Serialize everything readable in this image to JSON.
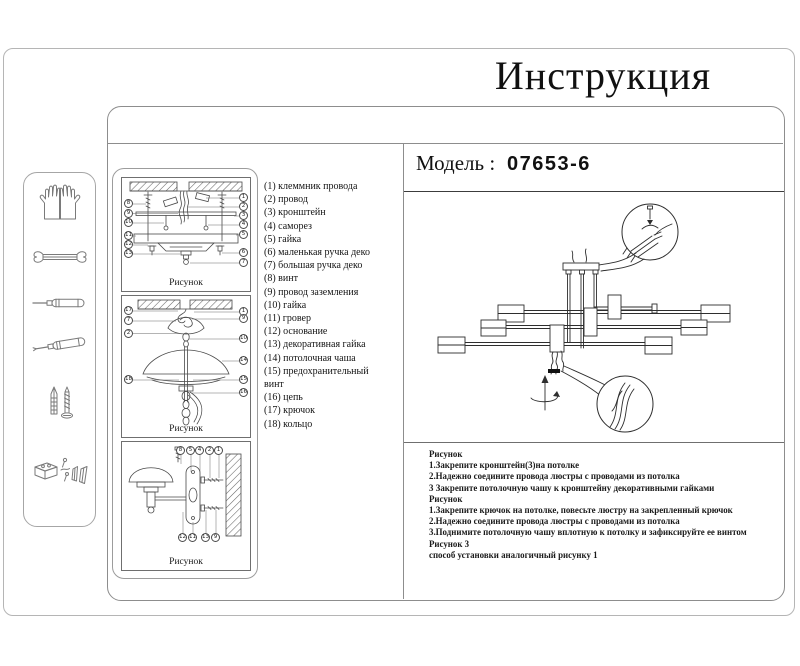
{
  "title": "Инструкция",
  "model": {
    "label": "Модель :",
    "value": "07653-6"
  },
  "parts_list": [
    "(1) клеммник провода",
    "(2) провод",
    "(3) кронштейн",
    "(4) саморез",
    "(5) гайка",
    "(6) маленькая ручка деко",
    "(7) большая ручка деко",
    "(8) винт",
    "(9) провод заземления",
    "(10) гайка",
    "(11) гровер",
    "(12) основание",
    "(13) декоративная гайка",
    "(14) потолочная чаша",
    "(15) предохранительный винт",
    "(16) цепь",
    "(17) крючок",
    "(18) кольцо"
  ],
  "figures": {
    "fig1": {
      "caption": "Рисунок",
      "callouts_left": [
        "8",
        "9",
        "10",
        "11",
        "12",
        "13"
      ],
      "callouts_right": [
        "1",
        "2",
        "3",
        "4",
        "5",
        "6",
        "7"
      ]
    },
    "fig2": {
      "caption": "Рисунок",
      "callouts_left": [
        "17",
        "7",
        "2",
        "18"
      ],
      "callouts_right": [
        "1",
        "9",
        "10",
        "14",
        "15",
        "16"
      ]
    },
    "fig3": {
      "caption": "Рисунок",
      "callouts_top": [
        "8",
        "5",
        "4",
        "2",
        "1"
      ],
      "callouts_bottom": [
        "12",
        "11",
        "13",
        "9"
      ]
    }
  },
  "instructions": [
    "Рисунок",
    "1.Закрепите кронштейн(3)на потолке",
    "2.Надежно соедините провода люстры с проводами из потолка",
    "3 Закрепите потолочную чашу к кронштейну декоративными гайками",
    "Рисунок",
    "1.Закрепите крючок на потолке, повесьте люстру на закрепленный крючок",
    "2.Надежно соедините провода люстры с проводами из потолка",
    "3.Поднимите потолочную чашу вплотную к потолку и зафиксируйте ее винтом",
    "Рисунок 3",
    "способ установки аналогичный рисунку 1"
  ],
  "sidebar_tools": [
    "gloves-icon",
    "wrench-icon",
    "flat-screwdriver-icon",
    "phillips-screwdriver-icon",
    "anchor-and-screw-icon",
    "mounting-hardware-icon"
  ],
  "colors": {
    "frame_border": "#8d8d8d",
    "drawing_line": "#2e2e2e",
    "text": "#161616"
  }
}
